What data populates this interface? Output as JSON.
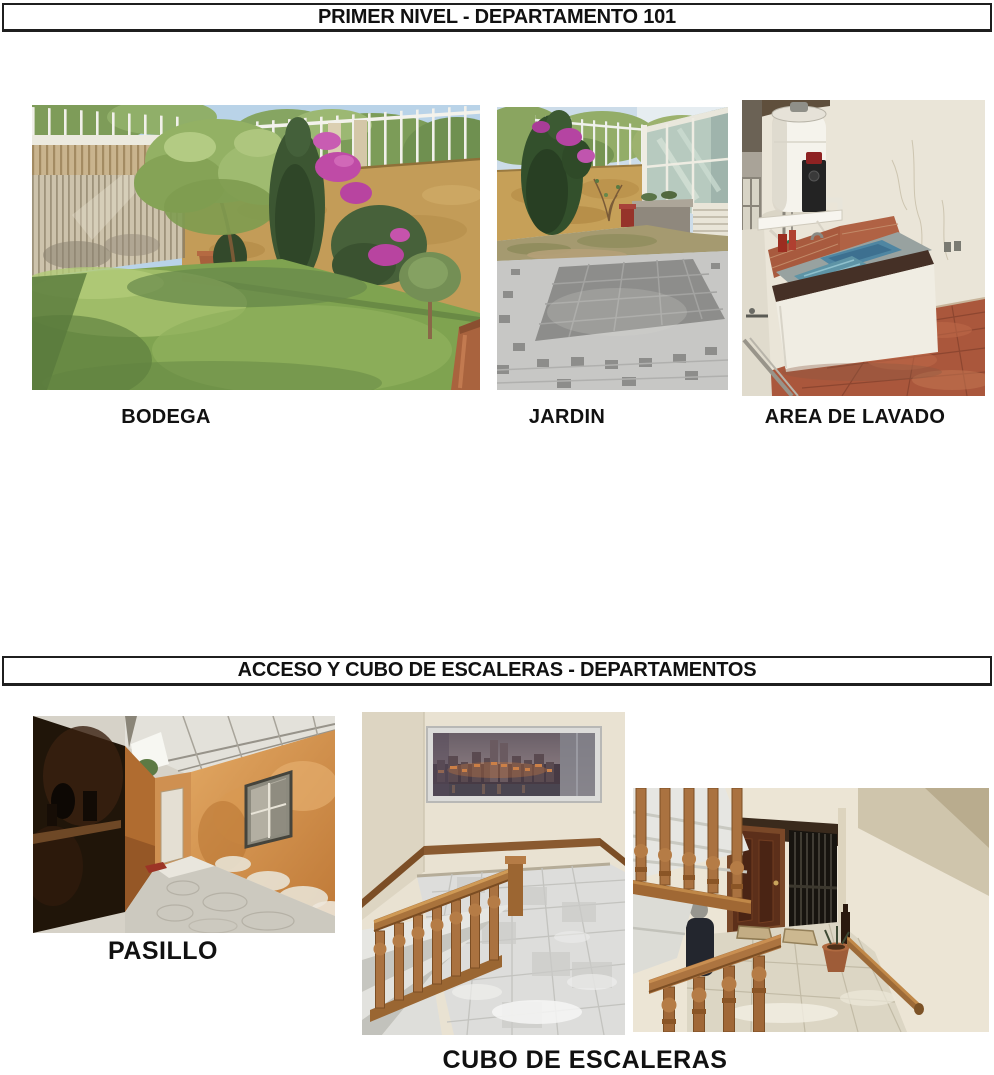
{
  "colors": {
    "page_background": "#ffffff",
    "header_border": "#1f1f1f",
    "text": "#111111",
    "ochre_wall": "#c39c58",
    "lawn_green": "#7fa350",
    "bougainvillea": "#bf4ba6",
    "wood": "#a9733c",
    "terracotta_floor": "#aa573c"
  },
  "sections": [
    {
      "title": "PRIMER NIVEL - DEPARTAMENTO 101",
      "photos": [
        {
          "caption": "BODEGA",
          "alt": "garden lawn with trees, bougainvillea, ochre wall, white fence and slatted gate"
        },
        {
          "caption": "JARDIN",
          "alt": "stone paved patio with conifer tree, ochre wall and glass structure"
        },
        {
          "caption": "AREA DE LAVADO",
          "alt": "laundry area with water heater, wash sink and terracotta tile floor"
        }
      ]
    },
    {
      "title": "ACCESO Y CUBO DE ESCALERAS - DEPARTAMENTOS",
      "photos": [
        {
          "caption": "PASILLO",
          "alt": "narrow corridor with orange walls, skylight roof and concrete floor"
        },
        {
          "caption": "CUBO DE ESCALERAS",
          "alt": "wooden staircase landing with city skyline picture"
        },
        {
          "alt": "stairwell with wooden balustrade, apartment door and metal gate"
        }
      ]
    }
  ]
}
